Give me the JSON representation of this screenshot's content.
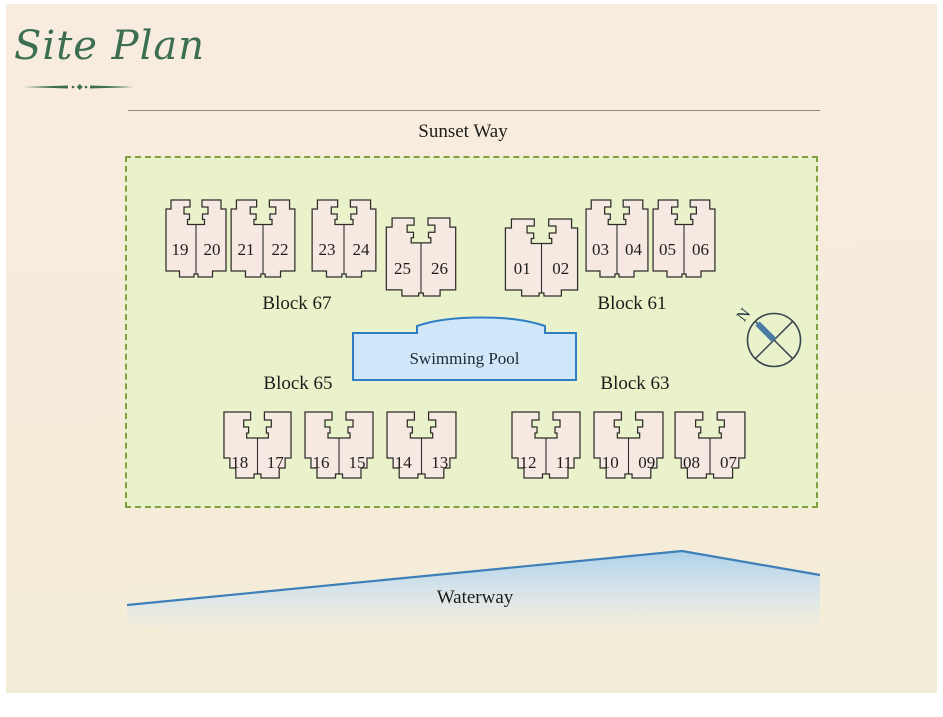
{
  "title": {
    "text": "Site Plan"
  },
  "roads": {
    "top": "Sunset Way",
    "bottom": "Waterway"
  },
  "pool": {
    "label": "Swimming Pool"
  },
  "compass": {
    "label": "N"
  },
  "blocks": [
    {
      "name": "Block 67",
      "buildings": [
        {
          "units": [
            "19",
            "20"
          ]
        },
        {
          "units": [
            "21",
            "22"
          ]
        },
        {
          "units": [
            "23",
            "24"
          ]
        },
        {
          "units": [
            "25",
            "26"
          ]
        }
      ]
    },
    {
      "name": "Block 61",
      "buildings": [
        {
          "units": [
            "01",
            "02"
          ]
        },
        {
          "units": [
            "03",
            "04"
          ]
        },
        {
          "units": [
            "05",
            "06"
          ]
        }
      ]
    },
    {
      "name": "Block 65",
      "buildings": [
        {
          "units": [
            "18",
            "17"
          ]
        },
        {
          "units": [
            "16",
            "15"
          ]
        },
        {
          "units": [
            "14",
            "13"
          ]
        }
      ]
    },
    {
      "name": "Block 63",
      "buildings": [
        {
          "units": [
            "12",
            "11"
          ]
        },
        {
          "units": [
            "10",
            "09"
          ]
        },
        {
          "units": [
            "08",
            "07"
          ]
        }
      ]
    }
  ],
  "colors": {
    "accent_green": "#3c6e52",
    "site_fill": "#eaf2cb",
    "site_border": "#7da23f",
    "building_fill": "#f6e9e1",
    "pool_fill": "#cfe7f8",
    "pool_border": "#2f7dc2",
    "water_line": "#3d7fb8",
    "water_fill": "#a9cfec"
  }
}
